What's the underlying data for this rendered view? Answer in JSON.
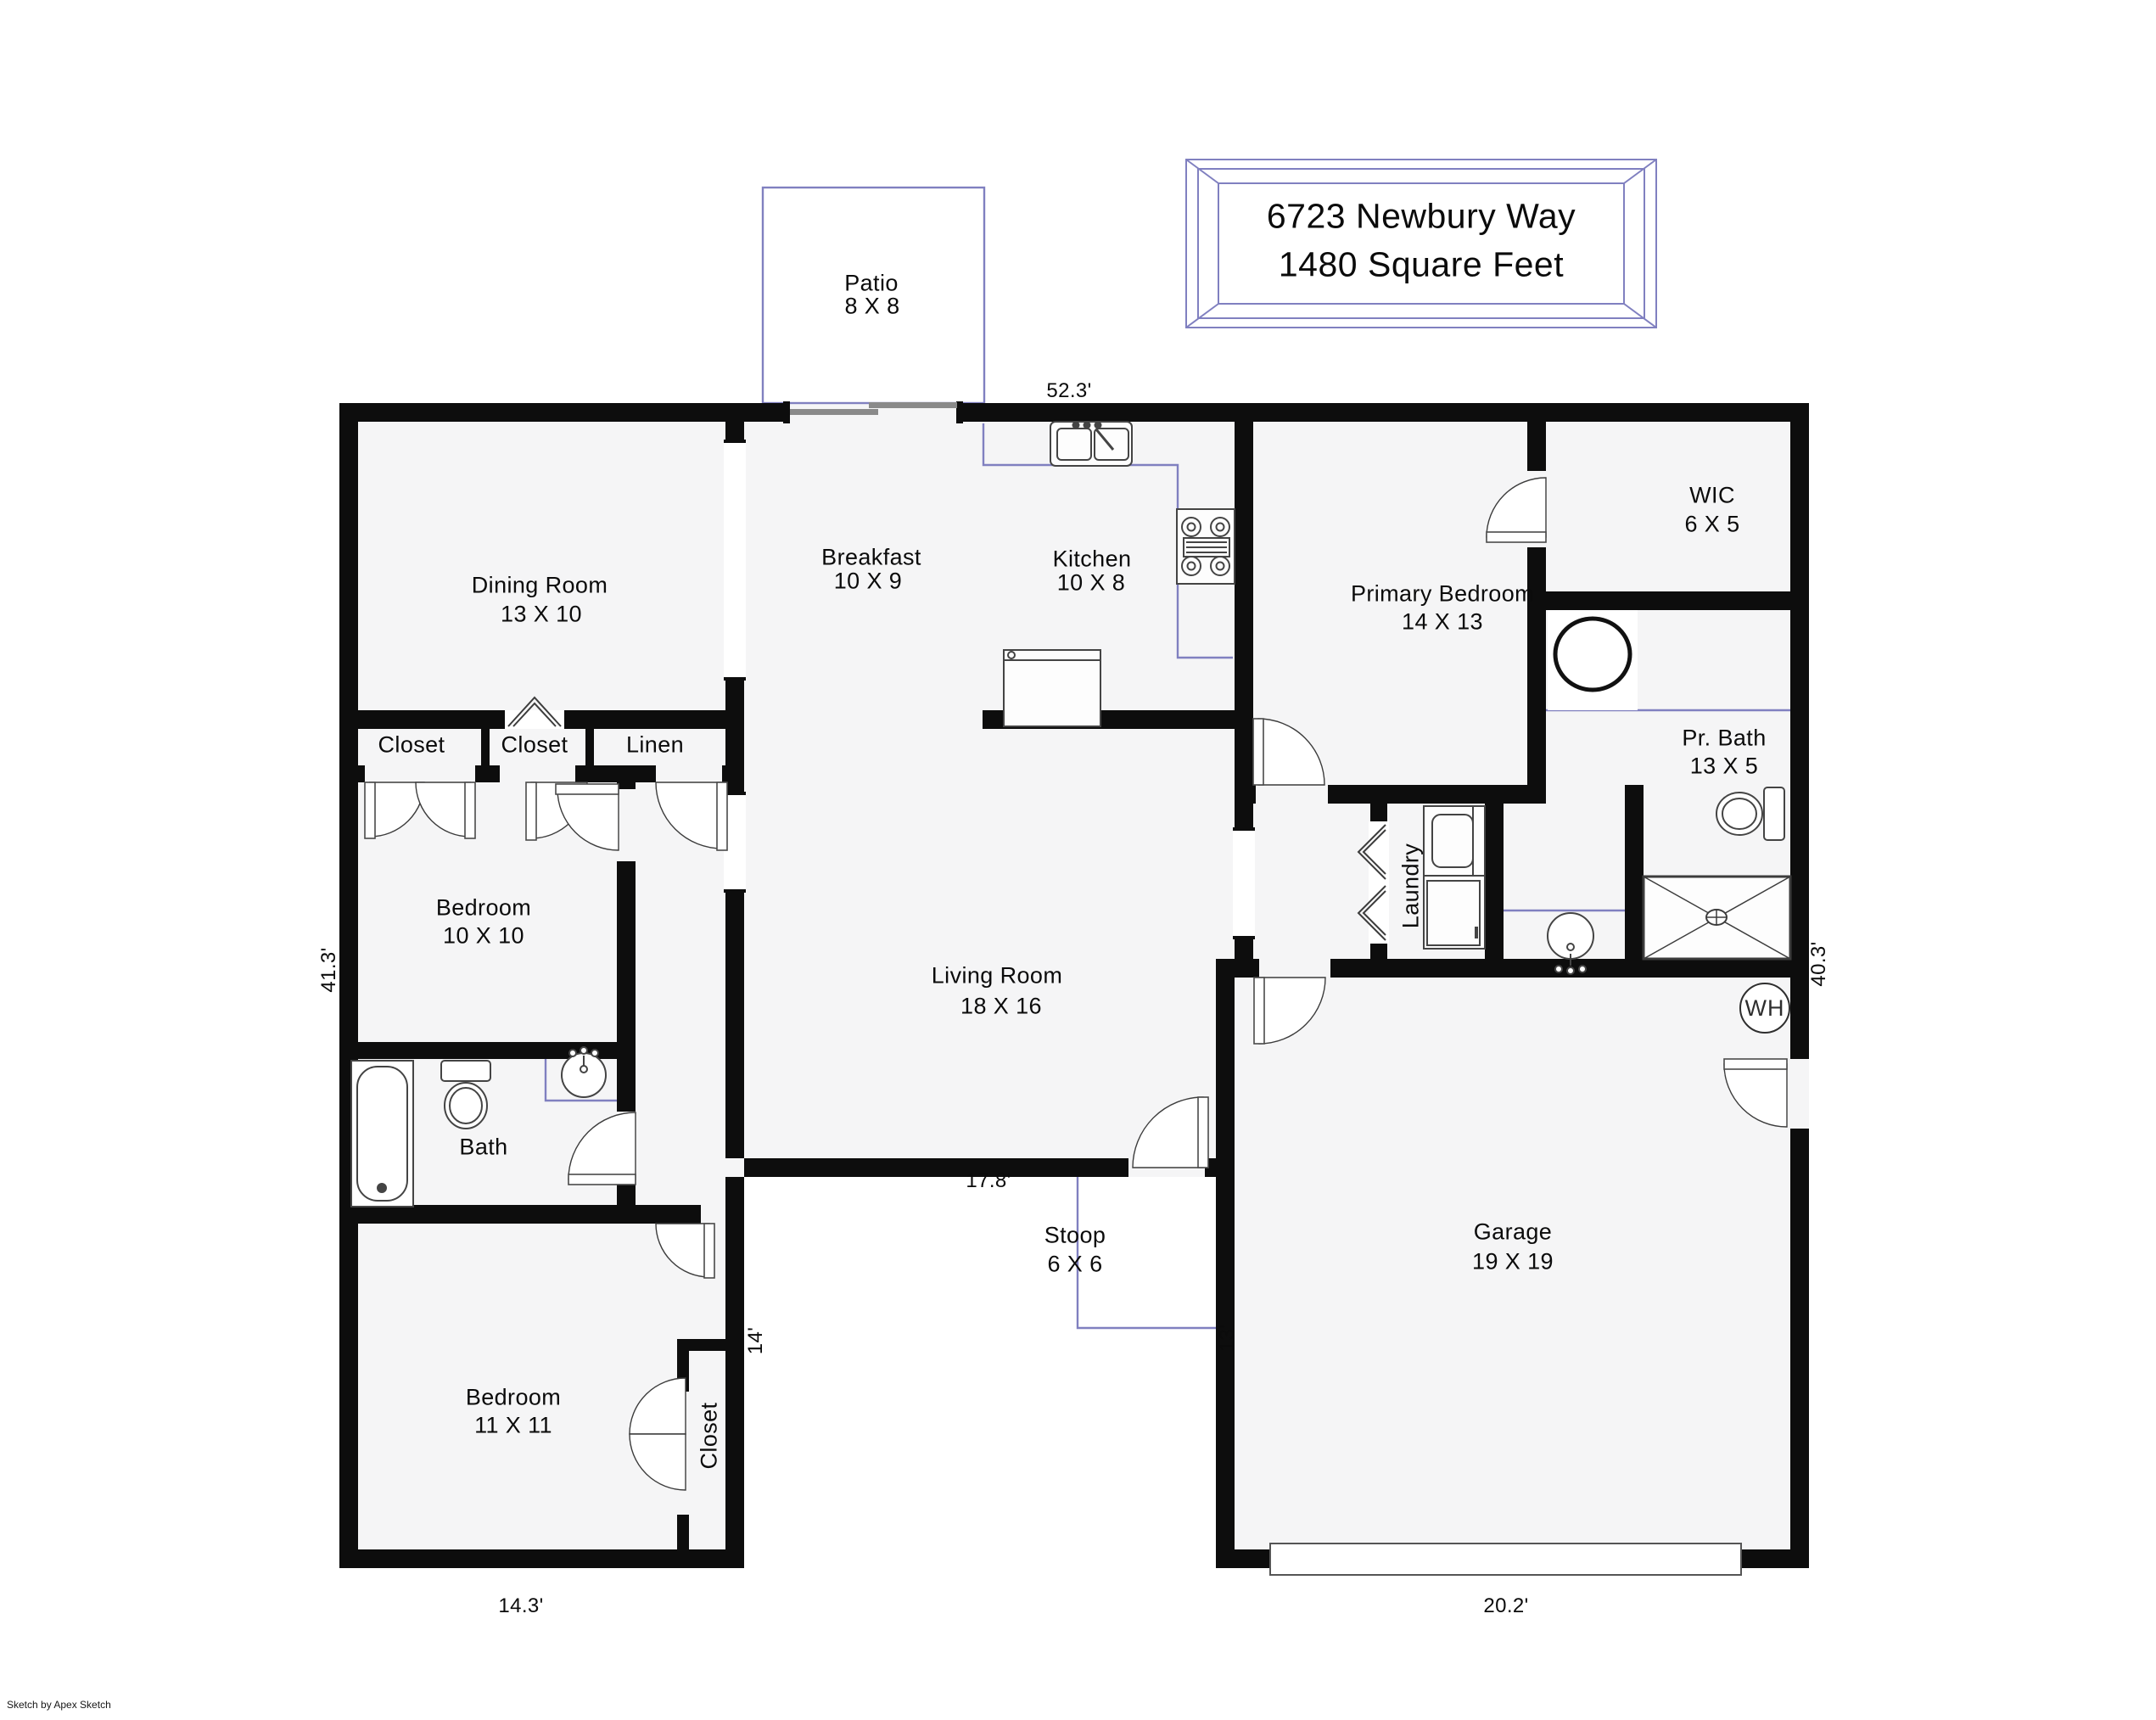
{
  "title_block": {
    "line1": "6723 Newbury Way",
    "line2": "1480 Square Feet"
  },
  "rooms": {
    "patio": {
      "name": "Patio",
      "dims": "8 X 8"
    },
    "dining": {
      "name": "Dining Room",
      "dims": "13 X 10"
    },
    "breakfast": {
      "name": "Breakfast",
      "dims": "10 X 9"
    },
    "kitchen": {
      "name": "Kitchen",
      "dims": "10 X 8"
    },
    "primary_bedroom": {
      "name": "Primary Bedroom",
      "dims": "14 X 13"
    },
    "wic": {
      "name": "WIC",
      "dims": "6 X 5"
    },
    "pr_bath": {
      "name": "Pr. Bath",
      "dims": "13 X 5"
    },
    "laundry": {
      "name": "Laundry"
    },
    "living": {
      "name": "Living Room",
      "dims": "18 X 16"
    },
    "bedroom1": {
      "name": "Bedroom",
      "dims": "10 X 10"
    },
    "bath": {
      "name": "Bath"
    },
    "closet_a": {
      "name": "Closet"
    },
    "closet_b": {
      "name": "Closet"
    },
    "linen": {
      "name": "Linen"
    },
    "stoop": {
      "name": "Stoop",
      "dims": "6 X 6"
    },
    "garage": {
      "name": "Garage",
      "dims": "19 X 19"
    },
    "bedroom2": {
      "name": "Bedroom",
      "dims": "11 X 11"
    },
    "closet_c": {
      "name": "Closet"
    }
  },
  "dimensions": {
    "top": "52.3'",
    "left": "41.3'",
    "right": "40.3'",
    "living_bottom": "17.8'",
    "stoop_side": "13'",
    "wing_side": "14'",
    "wing_bottom": "14.3'",
    "garage_bottom": "20.2'"
  },
  "fixtures": {
    "water_heater": "WH"
  },
  "credit": "Sketch by Apex Sketch"
}
